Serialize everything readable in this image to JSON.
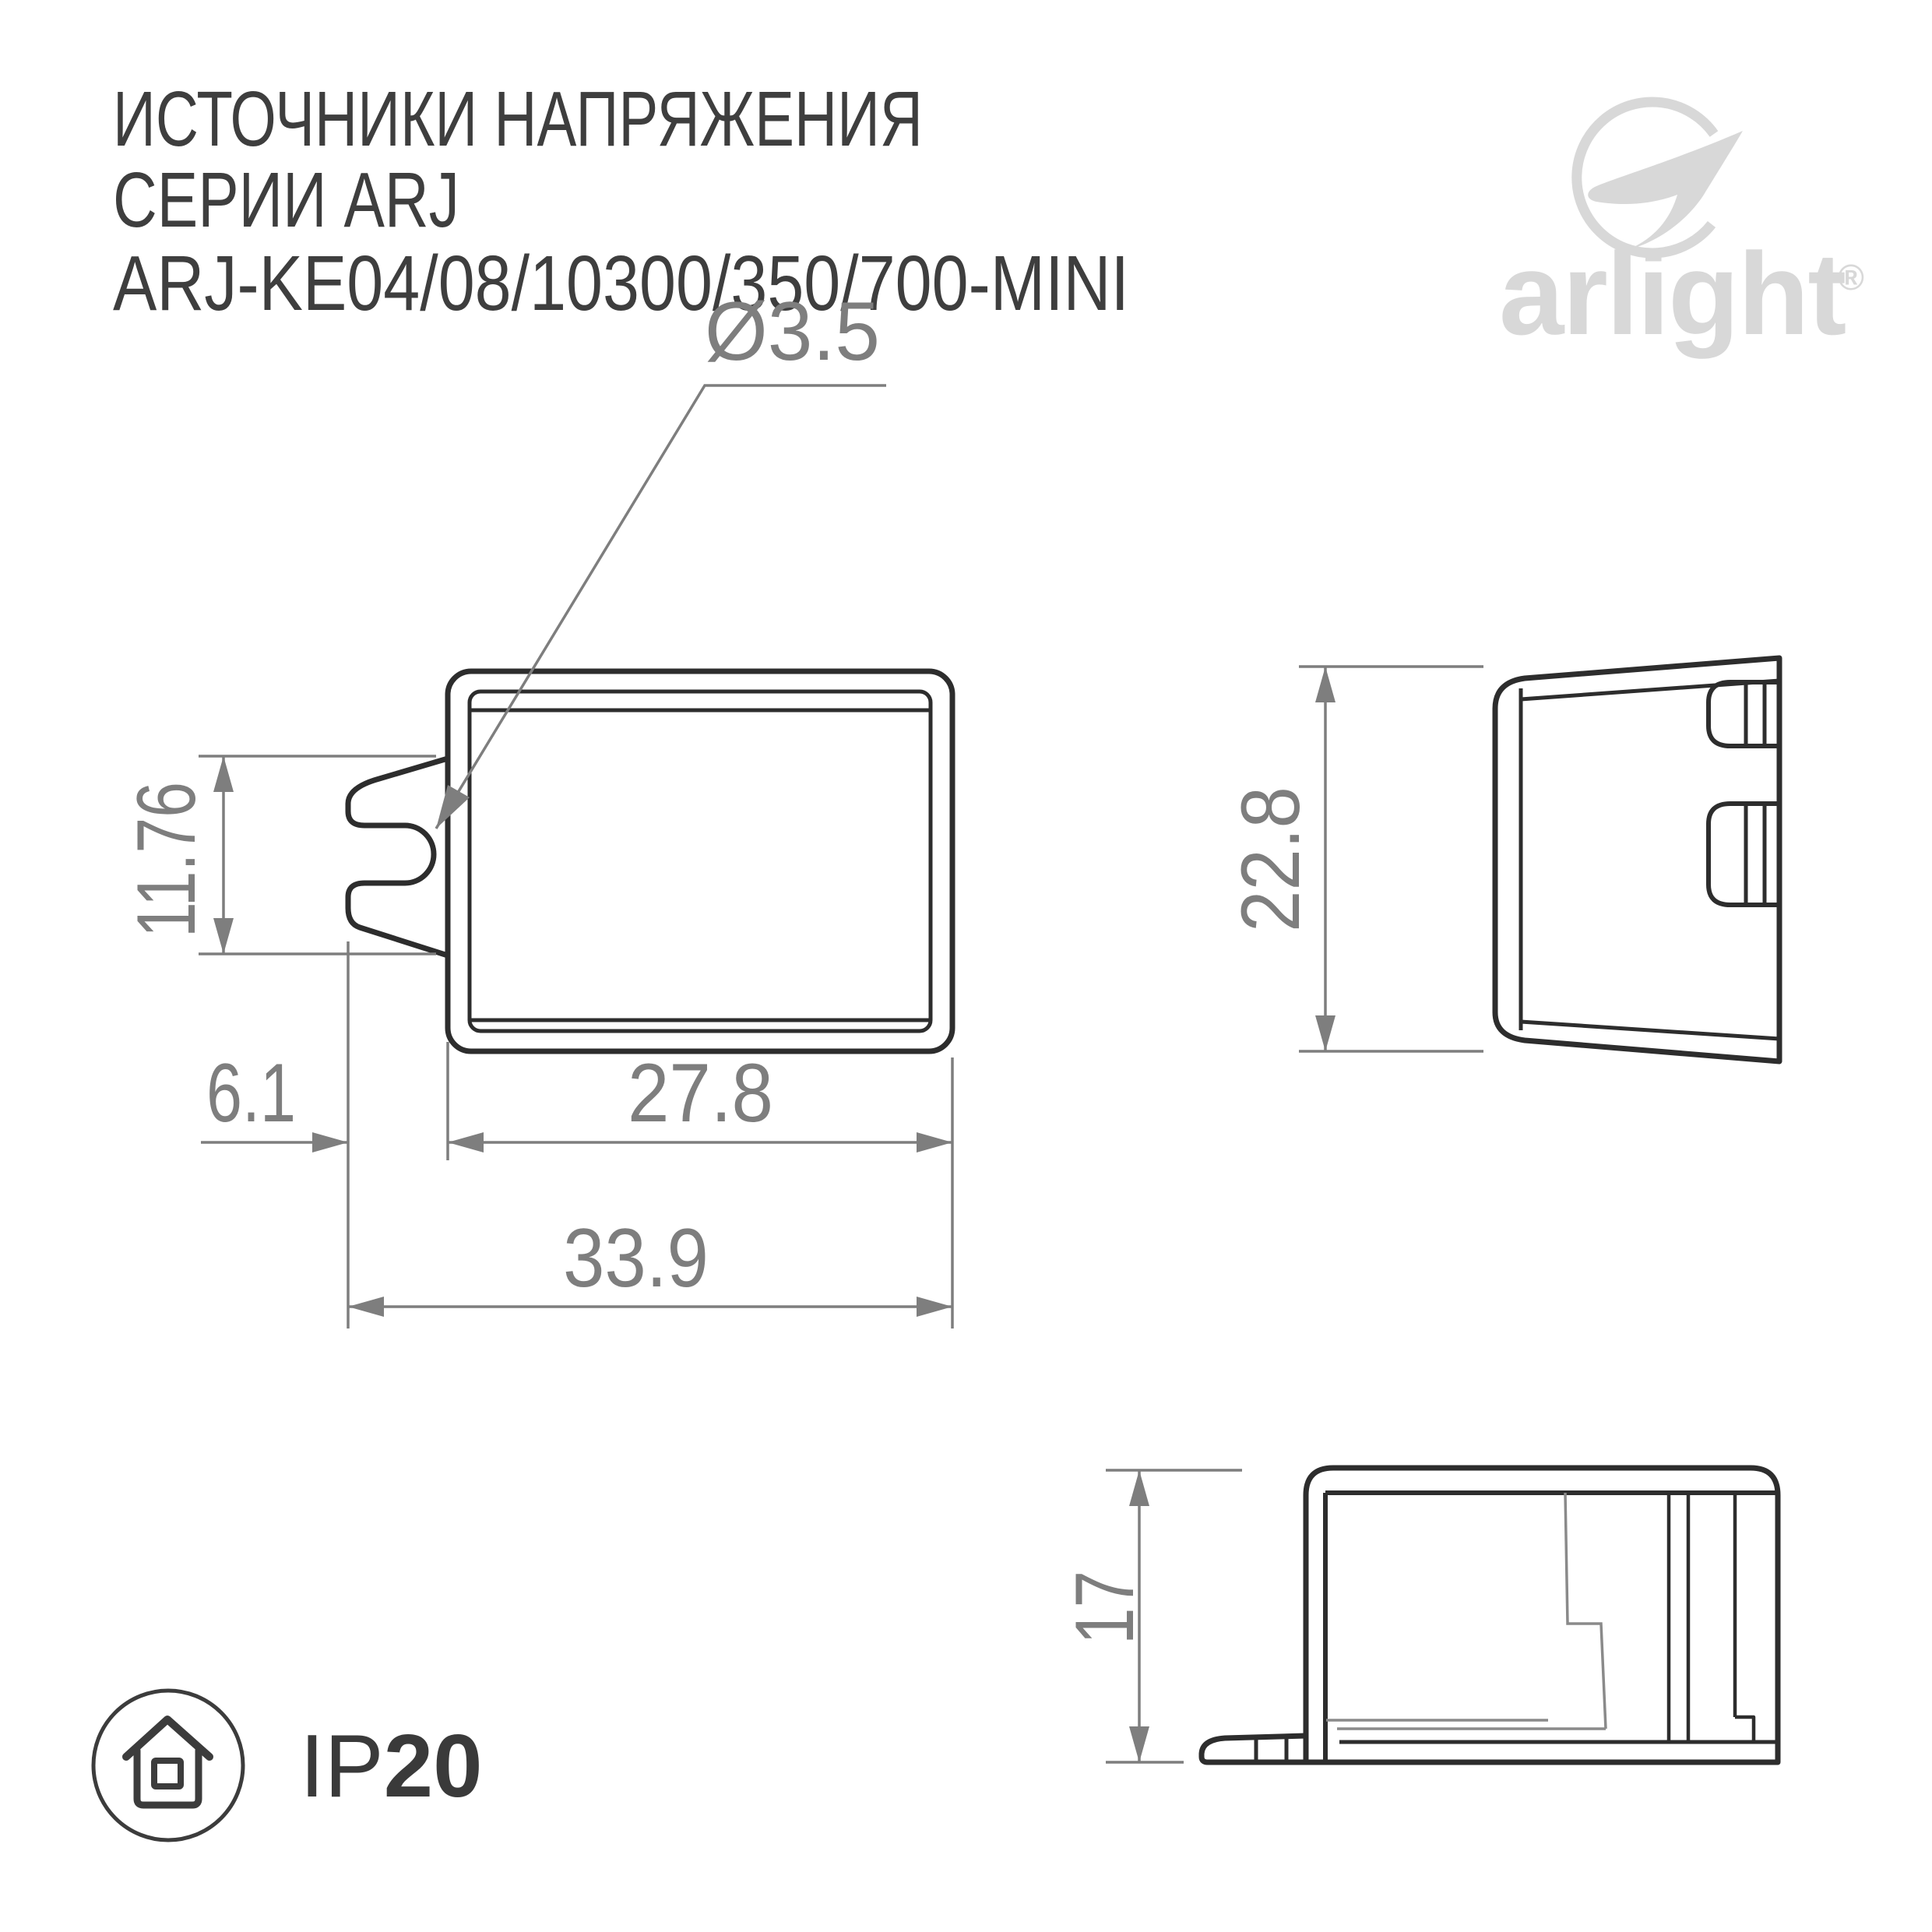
{
  "header": {
    "title_line1": "ИСТОЧНИКИ НАПРЯЖЕНИЯ",
    "title_line2": "СЕРИИ ARJ",
    "title_line3": "ARJ-KE04/08/10300/350/700-MINI"
  },
  "logo": {
    "brand": "arlight",
    "registered_mark": "®"
  },
  "drawing": {
    "front_view": {
      "hole_diameter": "Ø3.5",
      "clip_span": "11.76",
      "clip_offset": "6.1",
      "body_width": "27.8",
      "overall_width": "33.9"
    },
    "side_view": {
      "overall_height": "22.8"
    },
    "profile_view": {
      "overall_height": "17"
    }
  },
  "badge": {
    "ip_code": "IP",
    "ip_value": "20"
  },
  "colors": {
    "outline": "#2d2d2d",
    "dimension": "#7e7e7e",
    "logo": "#d8d8d8",
    "title": "#3e3e3e"
  }
}
